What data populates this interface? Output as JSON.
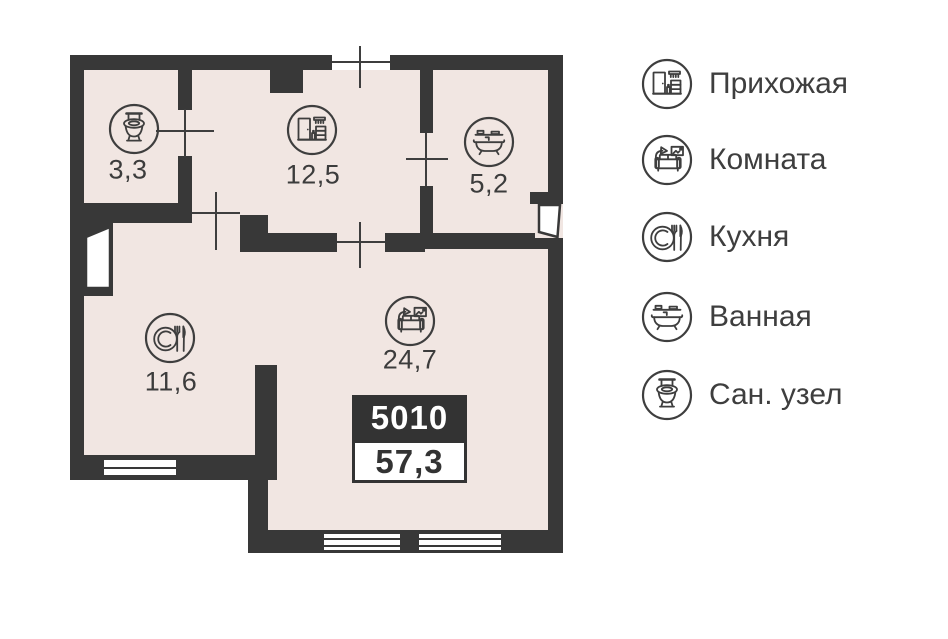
{
  "plan": {
    "unit_number": "5010",
    "total_area": "57,3",
    "rooms": [
      {
        "name": "Сан. узел",
        "area": "3,3",
        "icon": "toilet-icon"
      },
      {
        "name": "Прихожая",
        "area": "12,5",
        "icon": "hallway-icon"
      },
      {
        "name": "Ванная",
        "area": "5,2",
        "icon": "bath-icon"
      },
      {
        "name": "Кухня",
        "area": "11,6",
        "icon": "kitchen-icon"
      },
      {
        "name": "Комната",
        "area": "24,7",
        "icon": "room-icon"
      }
    ]
  },
  "legend": {
    "items": [
      {
        "label": "Прихожая",
        "icon": "hallway-icon"
      },
      {
        "label": "Комната",
        "icon": "room-icon"
      },
      {
        "label": "Кухня",
        "icon": "kitchen-icon"
      },
      {
        "label": "Ванная",
        "icon": "bath-icon"
      },
      {
        "label": "Сан. узел",
        "icon": "toilet-icon"
      }
    ]
  },
  "colors": {
    "wall": "#383838",
    "floor": "#f1e6e2",
    "icon_line": "#3e3e3e",
    "text": "#3c3c3c",
    "badge_background": "#333333",
    "badge_text": "#ffffff"
  }
}
